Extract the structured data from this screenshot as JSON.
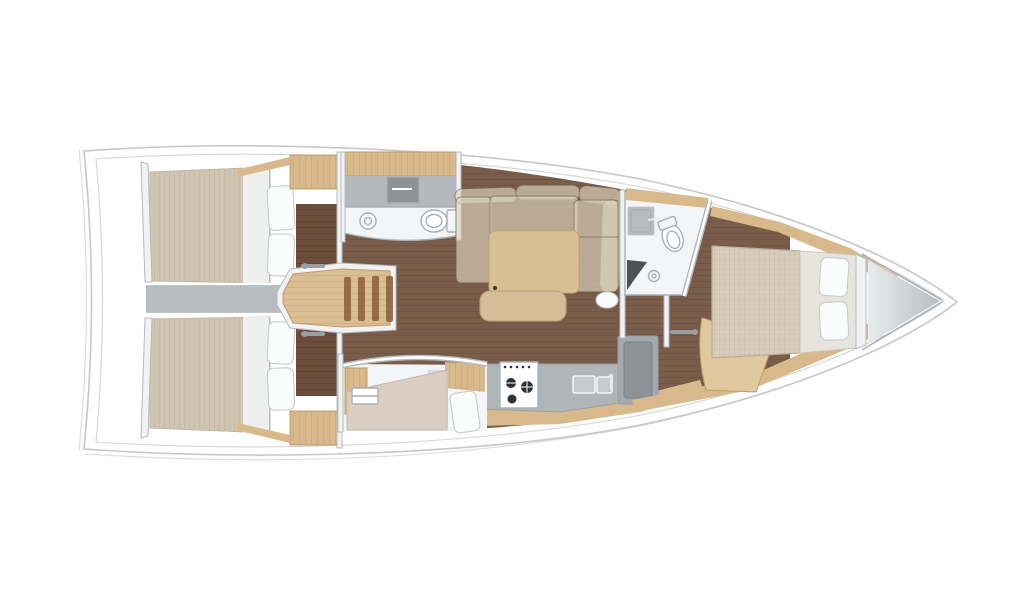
{
  "meta": {
    "label": "Sailing yacht interior floor plan, top-down view, bow pointing right",
    "view": "top-down"
  },
  "palette": {
    "pageBg": "#ffffff",
    "deckWhite": "#ffffff",
    "hullStroke": "#c5c7c9",
    "hullStrokeSoft": "#dcdee0",
    "innerLine": "#d2d4d6",
    "wallFill": "#f0f2f3",
    "wallStroke": "#b5babe",
    "floorBrown": "#7a5c4b",
    "floorLine": "#64483a",
    "floorDark": "#6d4e3d",
    "floorDarkLine": "#583f31",
    "mattress": "#cfc5b1",
    "mattressLine": "#c2b7a2",
    "mattressFwd": "#d7cdba",
    "mattressFwdLine": "#cabfa9",
    "bedHead": "#e6e4dc",
    "runner": "#eef0ef",
    "pillow": "#fafbfb",
    "pillowStroke": "#c7cbcf",
    "oak": "#d8b98c",
    "oakDark": "#c09b6a",
    "oakLight": "#e0c89f",
    "landingWood": "#d9bf93",
    "stepSlat": "#8a5c38",
    "sofa": "#ded5bf",
    "sofaSeam": "#6e6652",
    "tableTan": "#d8c095",
    "tableStroke": "#bfa374",
    "stool": "#d5bf99",
    "counterGray": "#b0b5b8",
    "counterStroke": "#9aa0a3",
    "bathFloor": "#f3f5f6",
    "bathCounter": "#b4b9bd",
    "fixtureStroke": "#aab0b4",
    "grayModule": "#a4a9ad",
    "grayLid": "#8d9296",
    "corridor": "#b7bdc1",
    "anchorLight": "#e9ebed",
    "anchorDark": "#a9aeb2",
    "stoveDark": "#2e3234",
    "seatDark": "#4c5155",
    "handle": "#999fa3"
  },
  "layout": {
    "orientation": "bow-right",
    "rooms": [
      {
        "id": "aft-cabin-port",
        "furniture": [
          "double-bed",
          "pillows",
          "wardrobe-locker"
        ]
      },
      {
        "id": "aft-cabin-starboard",
        "furniture": [
          "double-bed",
          "pillows",
          "wardrobe-locker"
        ]
      },
      {
        "id": "engine-compartment",
        "furniture": []
      },
      {
        "id": "companionway",
        "furniture": [
          "stairs",
          "door-handles"
        ]
      },
      {
        "id": "aft-head",
        "furniture": [
          "sink",
          "toilet",
          "mirror-cabinet"
        ]
      },
      {
        "id": "saloon",
        "furniture": [
          "l-shaped-sofa",
          "table",
          "bench",
          "pouf"
        ]
      },
      {
        "id": "galley",
        "furniture": [
          "stove",
          "double-sink",
          "fridge"
        ]
      },
      {
        "id": "mid-cabin-starboard",
        "furniture": [
          "berth",
          "pillow",
          "washbasin"
        ]
      },
      {
        "id": "forward-head",
        "furniture": [
          "sink",
          "toilet",
          "shower",
          "shower-seat"
        ]
      },
      {
        "id": "forward-cabin",
        "furniture": [
          "island-double-bed",
          "pillows",
          "steps"
        ]
      },
      {
        "id": "anchor-locker",
        "furniture": []
      }
    ]
  }
}
